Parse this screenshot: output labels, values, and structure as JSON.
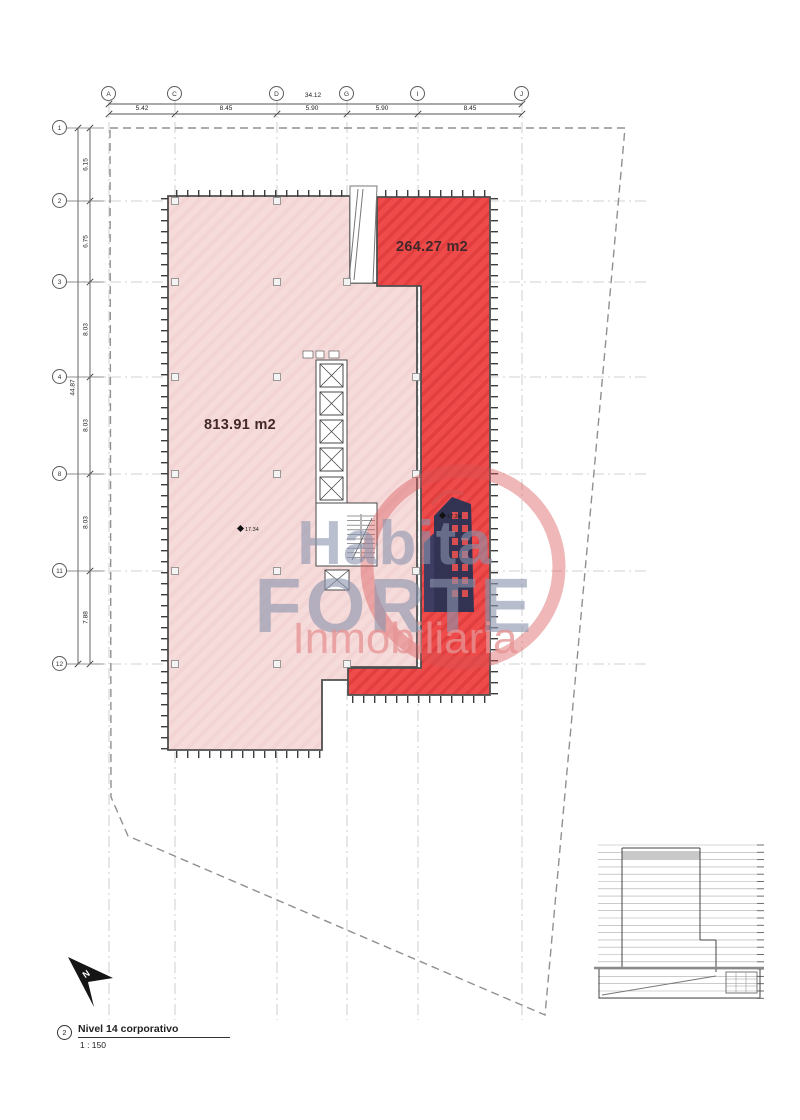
{
  "title_block": {
    "number": "2",
    "title": "Nivel 14 corporativo",
    "scale": "1 : 150"
  },
  "grid": {
    "top": {
      "labels": [
        "A",
        "C",
        "D",
        "G",
        "I",
        "J"
      ],
      "total": "34.12",
      "segments": [
        "5.42",
        "8.45",
        "5.90",
        "5.90",
        "8.45"
      ]
    },
    "left": {
      "labels": [
        "1",
        "2",
        "3",
        "4",
        "8",
        "11",
        "12"
      ],
      "total": "44.87",
      "segments": [
        "6.15",
        "6.75",
        "8.03",
        "8.03",
        "8.03",
        "7.88"
      ]
    }
  },
  "areas": {
    "highlight": {
      "label": "264.27 m2"
    },
    "floorplate": {
      "label": "813.91 m2"
    }
  },
  "levels": {
    "marker_left": "17.34",
    "marker_right": "17.34"
  },
  "watermark": {
    "line1": "Habita",
    "line2": "FORTE",
    "line3": "Inmobiliaria"
  },
  "compass": {
    "label": "N"
  },
  "colors": {
    "highlight_red": "#ef4b4b",
    "floorplate_pink": "#f6dbdb",
    "watermark_blue": "#8b95ad",
    "watermark_pink": "#e79494",
    "logo_navy": "#233155",
    "logo_red": "#d94f4f"
  }
}
